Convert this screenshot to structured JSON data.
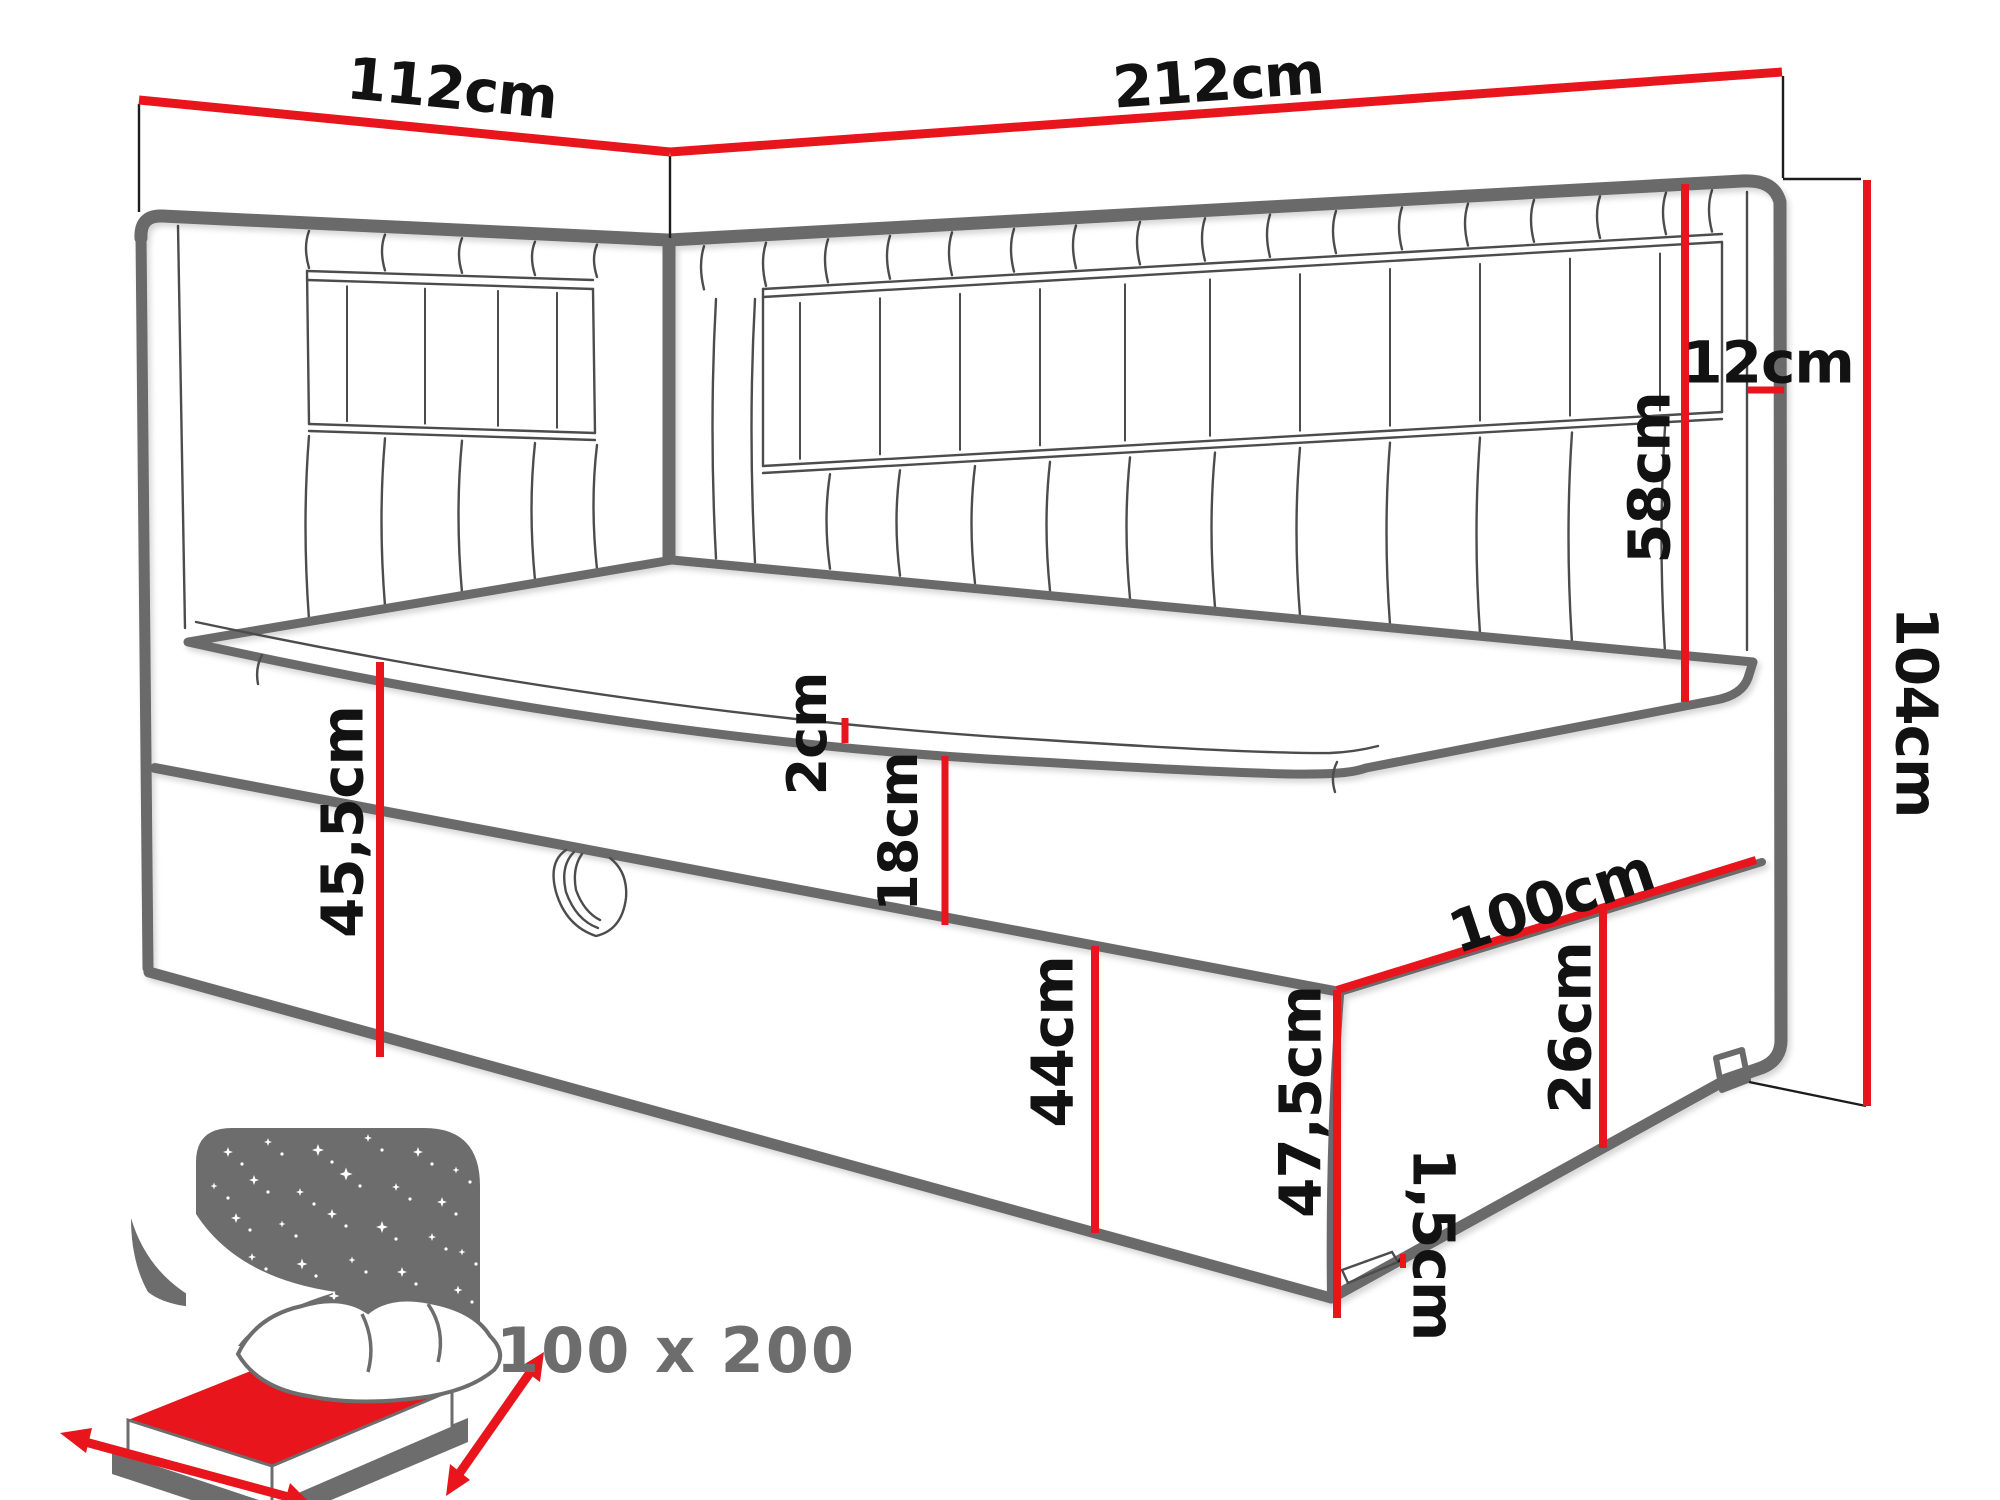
{
  "diagram": {
    "title_hint": "corner-bed-dimension-diagram",
    "colors": {
      "dimension_red": "#e8151d",
      "outline_gray": "#6a6a6a",
      "icon_gray": "#6d6d6d",
      "label_black": "#121212"
    },
    "labels": {
      "head_width": "112cm",
      "total_length": "212cm",
      "headboard_edge": "12cm",
      "headboard_above_seat": "58cm",
      "total_height": "104cm",
      "topper_thickness": "2cm",
      "mattress_thickness": "18cm",
      "side_height": "45,5cm",
      "drawer_front_height": "44cm",
      "end_width": "100cm",
      "base_end_height": "26cm",
      "corner_height": "47,5cm",
      "leg_height": "1,5cm"
    },
    "icon": {
      "size_label": "100 x 200"
    }
  }
}
